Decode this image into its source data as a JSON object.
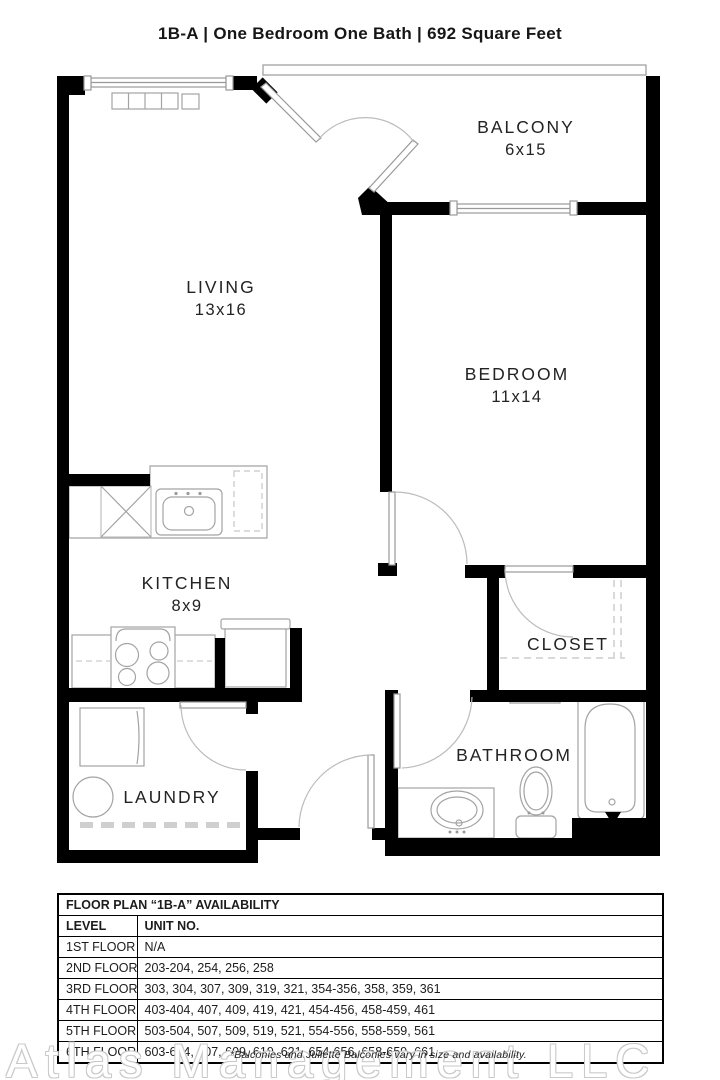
{
  "title": "1B-A | One Bedroom One Bath |  692 Square Feet",
  "rooms": [
    {
      "name": "BALCONY",
      "dims": "6x15"
    },
    {
      "name": "LIVING",
      "dims": "13x16"
    },
    {
      "name": "BEDROOM",
      "dims": "11x14"
    },
    {
      "name": "KITCHEN",
      "dims": "8x9"
    },
    {
      "name": "CLOSET",
      "dims": ""
    },
    {
      "name": "BATHROOM",
      "dims": ""
    },
    {
      "name": "LAUNDRY",
      "dims": ""
    }
  ],
  "availability": {
    "title": "FLOOR PLAN “1B-A” AVAILABILITY",
    "columns": [
      "LEVEL",
      "UNIT NO."
    ],
    "rows": [
      [
        "1ST FLOOR",
        "N/A"
      ],
      [
        "2ND FLOOR",
        "203-204, 254, 256, 258"
      ],
      [
        "3RD FLOOR",
        "303, 304, 307, 309, 319, 321, 354-356, 358, 359, 361"
      ],
      [
        "4TH FLOOR",
        "403-404, 407, 409, 419, 421, 454-456, 458-459, 461"
      ],
      [
        "5TH FLOOR",
        "503-504, 507, 509, 519, 521, 554-556, 558-559, 561"
      ],
      [
        "6TH FLOOR",
        "603-604, 607, 609, 619, 621, 654-656, 658-659, 661"
      ]
    ]
  },
  "watermark": "Atlas Management LLC",
  "footnote": "*Balconies and Juliette Balconies vary in size and availability.",
  "colors": {
    "wall": "#000000",
    "fixture_line": "#a3a3a3",
    "arc_line": "#bcbcbc"
  }
}
